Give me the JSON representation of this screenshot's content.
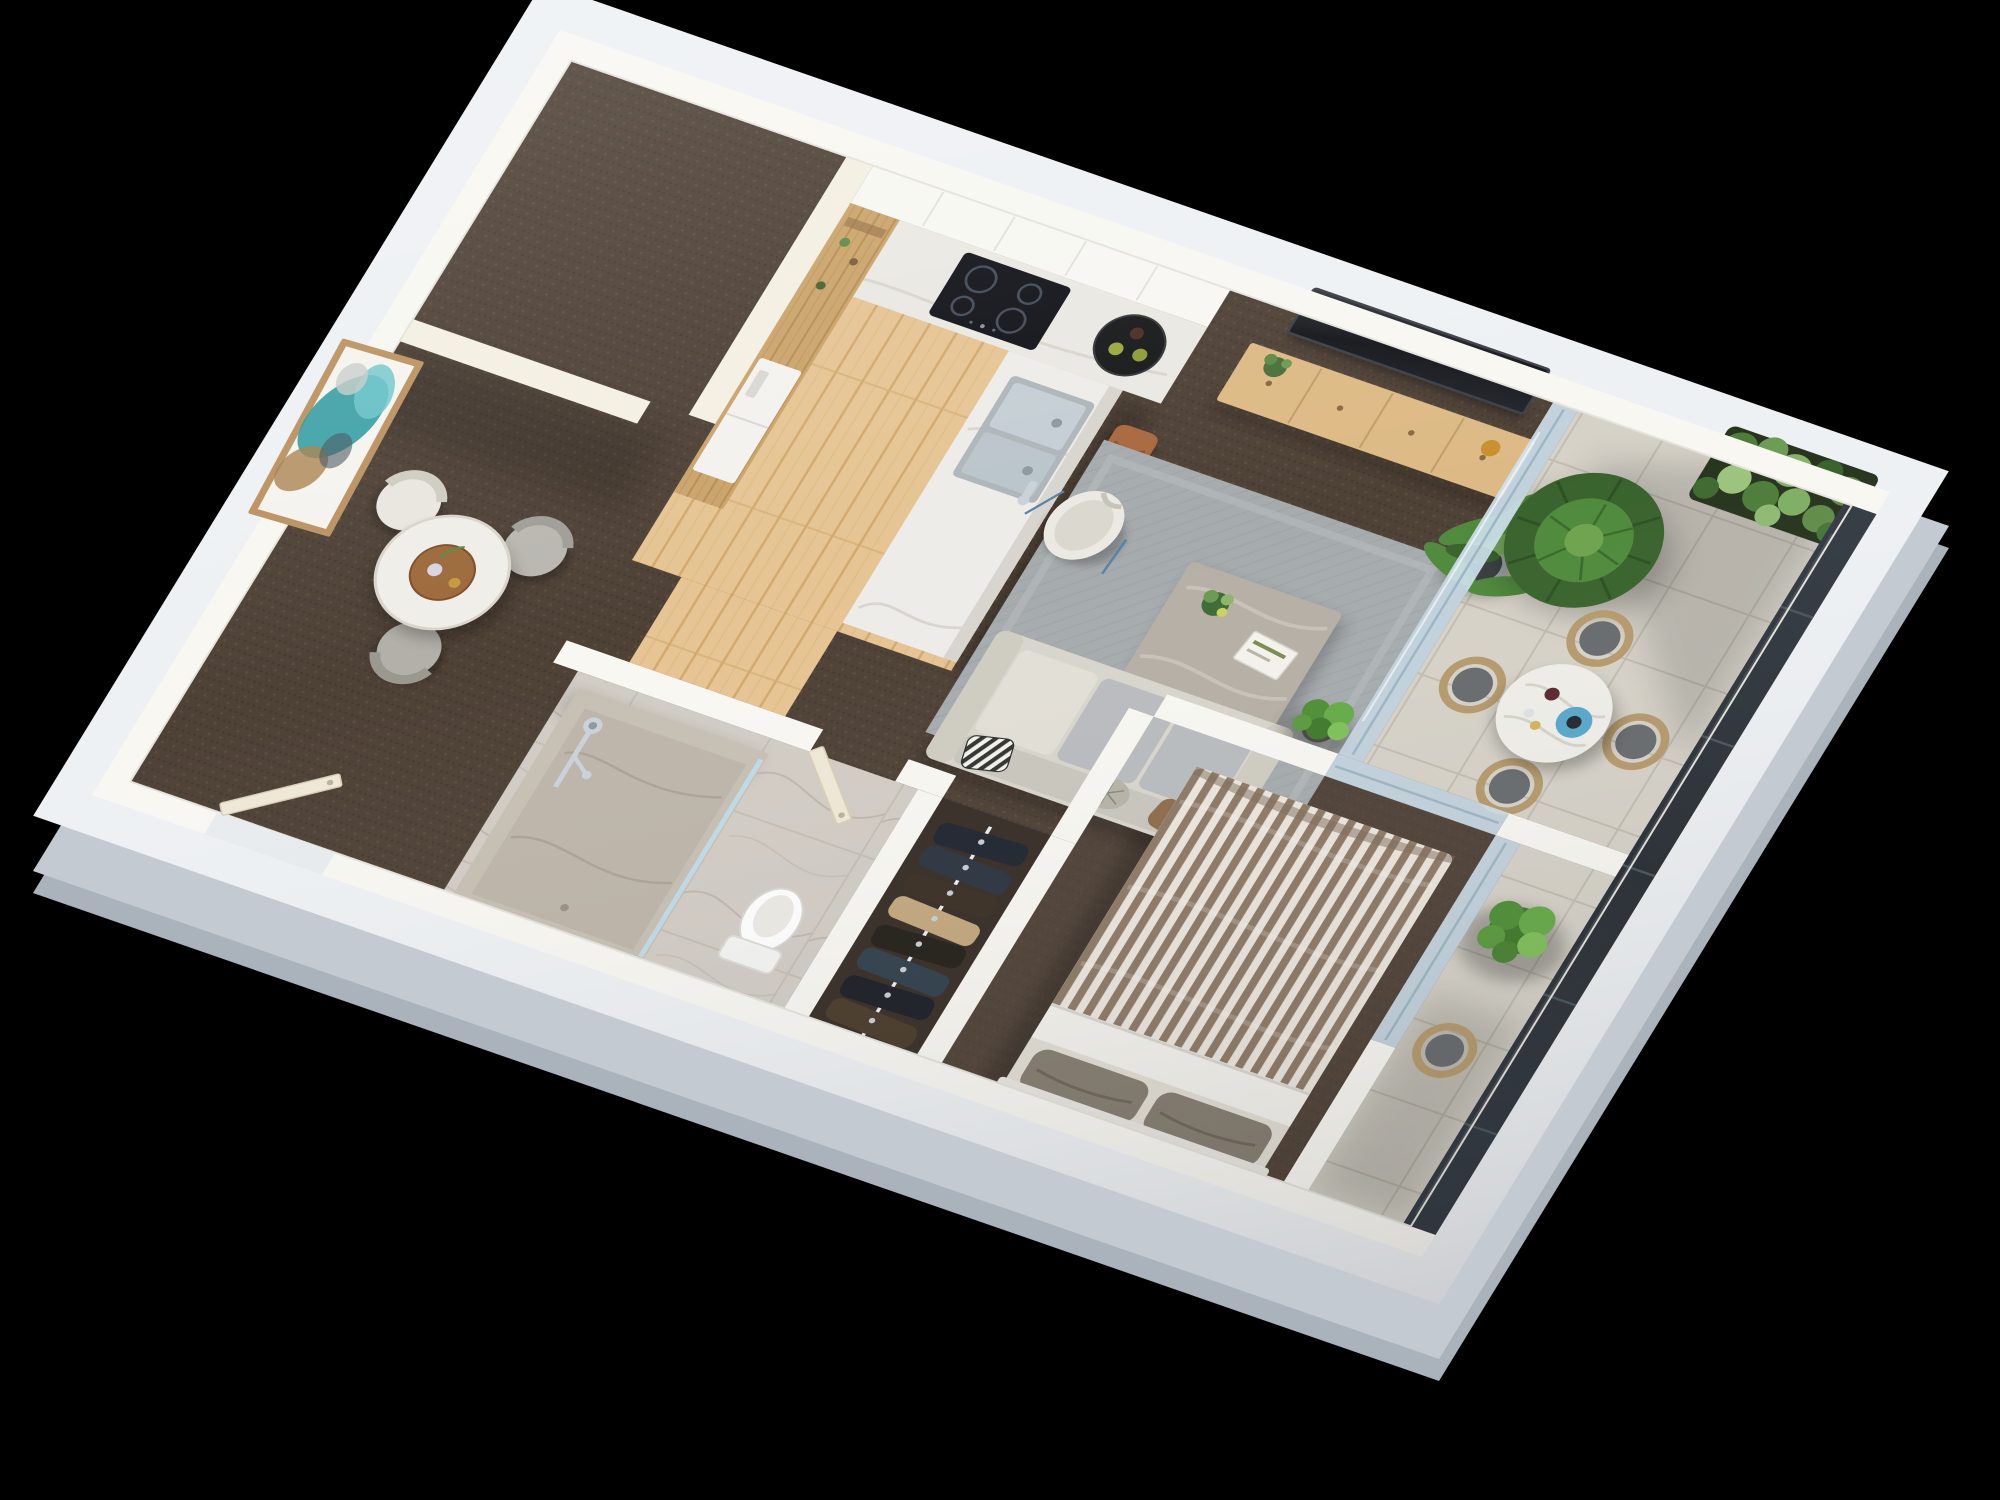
{
  "scene": {
    "description": "3D cutaway floor-plan render of a one-bedroom apartment viewed from above on a black background",
    "background": "#000000",
    "palette": {
      "slab": "#eef1f4",
      "slab_side": "#c3cad2",
      "slab_side_dark": "#aab2bb",
      "wall": "#f8f7f2",
      "wall_warm": "#f3efe2",
      "carpet": "#4e4136",
      "carpet_bedroom": "#51443a",
      "wood_floor": "#e6c493",
      "wood_cabinet": "#caa36a",
      "counter_marble": "#eae8e2",
      "island_marble": "#edece8",
      "island_side": "#d8d5cf",
      "bath_marble": "#d2ccc5",
      "shower_stone": "#c6bfb4",
      "tile": "#d6d2c8",
      "tile_grout": "#c2bdb1",
      "rug": "#a6abad",
      "rug_inner": "#b4b8ba",
      "sofa": "#d8d5cc",
      "sofa_cushion": "#b9bcbf",
      "tv": "#16181b",
      "console_wood": "#ddba85",
      "leather_stool": "#a9683f",
      "plant_green": "#4f8a3c",
      "plant_dark": "#39632c",
      "plant_light": "#74a85a",
      "glass": "#cfe2ee",
      "glass_frame": "#9db6c4",
      "dark_glazing": "#2c3238",
      "duvet_stripe_a": "#8d7a66",
      "duvet_stripe_b": "#ece7dd",
      "sheet_white": "#f3f2ed",
      "pillow_gray": "#857d71",
      "artwork_teal": "#2e9aa0",
      "artwork_cyan": "#6ec7cb",
      "artwork_ochre": "#a97f4a",
      "frame_gold": "#bb9260",
      "chair_rattan": "#b59a6c",
      "cushion_gray": "#676b6d",
      "toilet_white": "#ffffff",
      "door_cream": "#efe8d6",
      "chrome": "#c9d2d8",
      "sink_steel": "#c4ced4",
      "tray_black": "#17181a",
      "table_marble": "#efeee8",
      "table_tray_wood": "#9c6a3c",
      "blue_tray": "#58a8cc"
    },
    "wardrobe": {
      "rail_color": "#e8eef2",
      "colors": [
        "#20262f",
        "#2c3440",
        "#3a2f24",
        "#c3a87e",
        "#23201a",
        "#31404c",
        "#1b1e25",
        "#4a3b2a"
      ]
    },
    "rooms": [
      {
        "name": "kitchen",
        "floor": "timber boards",
        "features": [
          "white upper cabinets",
          "stone benchtop",
          "induction cooktop",
          "black serving tray with two glasses",
          "timber pantry shelves",
          "fridge",
          "island bench with double stainless sink",
          "four tan leather bar stools"
        ]
      },
      {
        "name": "living-room",
        "floor": "brown carpet",
        "features": [
          "wall-mounted TV",
          "timber media console",
          "grey area rug",
          "cream and grey modular sofa",
          "striped cushion",
          "stone coffee table with plant and book",
          "white sculptural accent chair",
          "tall potted palm"
        ]
      },
      {
        "name": "dining-nook-entry",
        "floor": "brown carpet",
        "features": [
          "round marble dining table with timber tray",
          "three tub chairs",
          "framed teal abstract artwork",
          "entry door"
        ]
      },
      {
        "name": "bathroom",
        "floor": "marble tile",
        "features": [
          "stone-walled walk-in shower",
          "chrome shower set",
          "glass screen",
          "toilet",
          "cream door"
        ]
      },
      {
        "name": "wardrobe",
        "floor": "dark carpet",
        "features": [
          "hanging rail",
          "eight hanging garments"
        ]
      },
      {
        "name": "bedroom",
        "floor": "brown carpet",
        "features": [
          "double bed with brown striped duvet",
          "white folded sheet",
          "two grey pillows",
          "sliding glass door to balcony"
        ]
      },
      {
        "name": "balcony-terrace",
        "floor": "stone tile",
        "features": [
          "round marble outdoor table",
          "wine bottle and glasses on blue tray",
          "four rattan armchairs",
          "vertical garden green wall",
          "large round potted palm",
          "full-height dark glazing"
        ]
      },
      {
        "name": "lower-balcony",
        "floor": "stone tile",
        "features": [
          "potted shrub",
          "rattan armchair"
        ]
      }
    ],
    "counts": {
      "bar_stools": 4,
      "dining_chairs": 3,
      "terrace_chairs": 4,
      "hanging_garments": 8,
      "bed_pillows": 2,
      "cooktop_burners": 4
    }
  }
}
